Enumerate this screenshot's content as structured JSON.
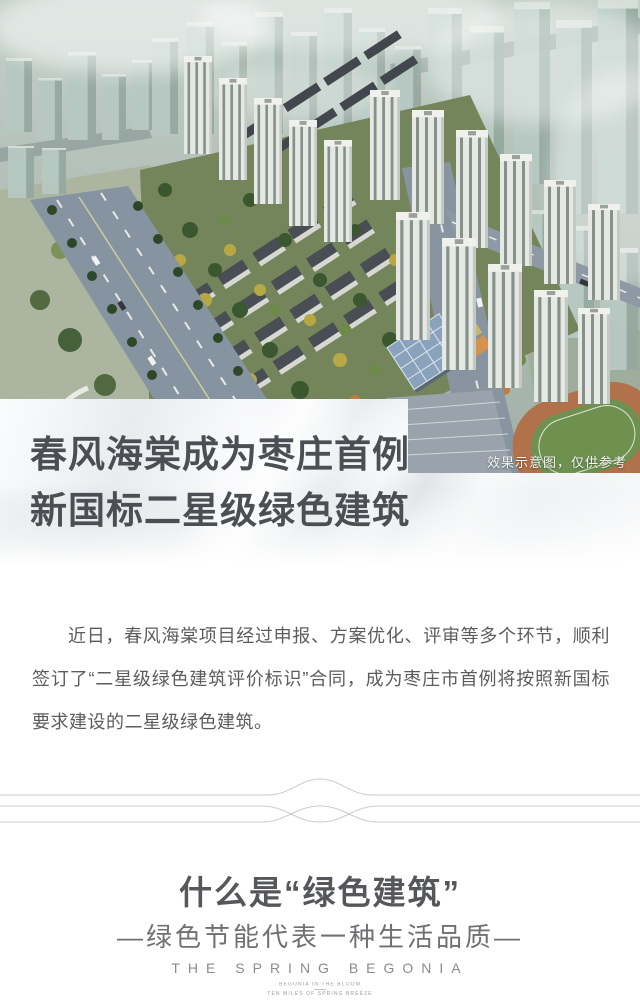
{
  "hero": {
    "caption": "效果示意图，仅供参考",
    "headline": {
      "line1": "春风海棠成为枣庄首例",
      "line2": "新国标二星级绿色建筑"
    }
  },
  "article": {
    "paragraph": "近日，春风海棠项目经过申报、方案优化、评审等多个环节，顺利签订了“二星级绿色建筑评价标识”合同，成为枣庄市首例将按照新国标要求建设的二星级绿色建筑。"
  },
  "section": {
    "title": "什么是“绿色建筑”",
    "subtitle": "—绿色节能代表一种生活品质—"
  },
  "footer": {
    "brand": "THE SPRING BEGONIA",
    "tagline_line1": "BEGONIA IN THE BLOOM",
    "tagline_line2": "TEN MILES OF SPRING BREEZE"
  },
  "colors": {
    "headline_text": "#4b4f53",
    "body_text": "#5c5c5c",
    "section_title": "#55575a",
    "section_subtitle": "#6f7073",
    "footer_text": "#8a8c8c",
    "caption_text": "#f3f6f4",
    "divider_line": "#cccccc"
  }
}
